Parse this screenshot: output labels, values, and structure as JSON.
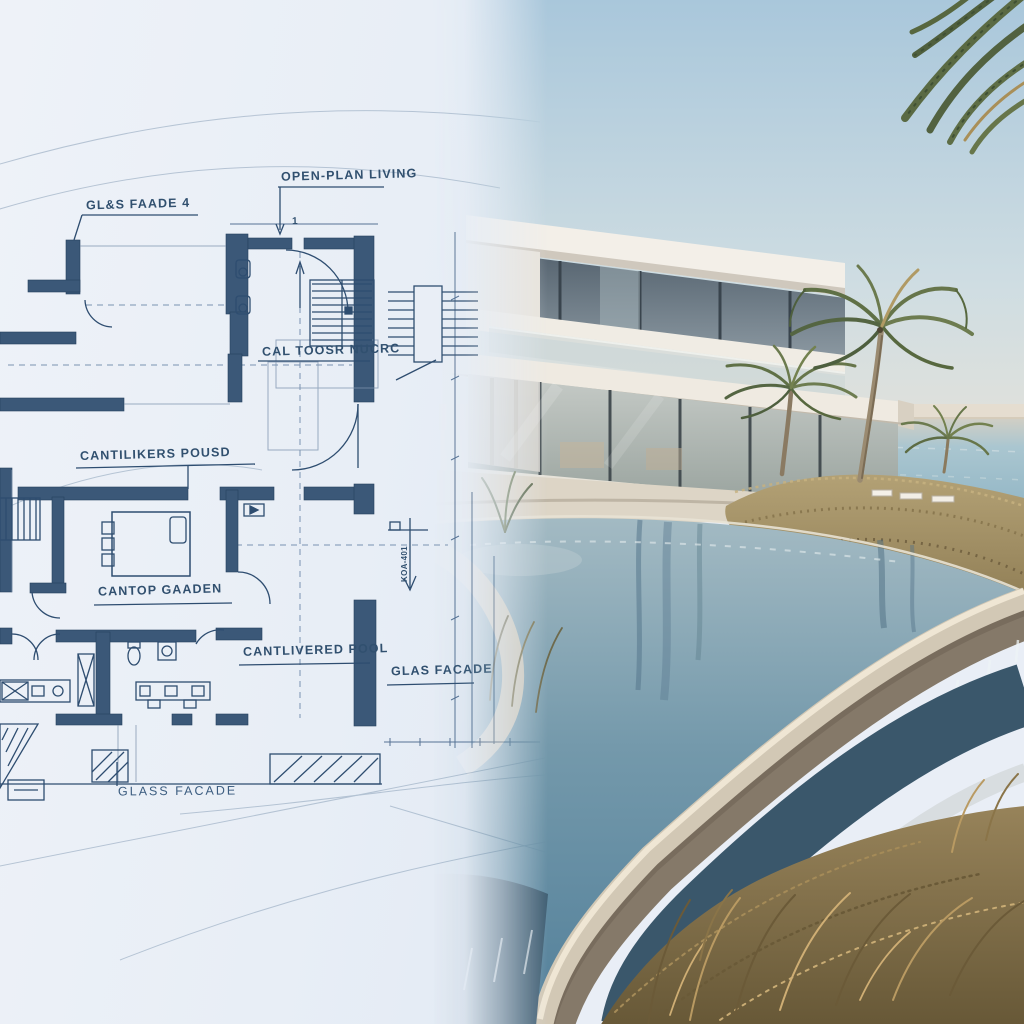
{
  "blueprint": {
    "annotations": [
      {
        "id": "glass-facade-top",
        "text": "GL&S FAADE 4"
      },
      {
        "id": "open-plan-living",
        "text": "OPEN-PLAN LIVING"
      },
      {
        "id": "stair-note",
        "text": "CAL TOOSR NUCRC"
      },
      {
        "id": "cantilevers-found",
        "text": "CANTILIKERS POUSD"
      },
      {
        "id": "rooftop-garden",
        "text": "CANTOP GAADEN"
      },
      {
        "id": "cantilevered-pool",
        "text": "CANTLIVERED POOL"
      },
      {
        "id": "glas-facade-mid",
        "text": "GLAS FACADE"
      },
      {
        "id": "glass-facade-bottom",
        "text": "GLASS FACADE"
      },
      {
        "id": "door-number",
        "text": "1"
      },
      {
        "id": "detail-tag",
        "text": "KOA-401"
      }
    ],
    "colors": {
      "paper": "#e9eef6",
      "ink": "#2e4d70",
      "wall": "#3b5878",
      "faint_line": "#8aa0b8"
    }
  },
  "photo": {
    "colors": {
      "sky_top": "#adc9dc",
      "sky_horizon": "#ece5d9",
      "ocean": "#9fc0cd",
      "pool": "#6f94a8",
      "pool_deep": "#3c5a6e",
      "rim_concrete": "#d6ccba",
      "house": "#f2eee7",
      "glass": "#5c6a75",
      "palm": "#67764a",
      "dune_grass": "#a08c5f",
      "dry_grass": "#8f7c52"
    }
  }
}
